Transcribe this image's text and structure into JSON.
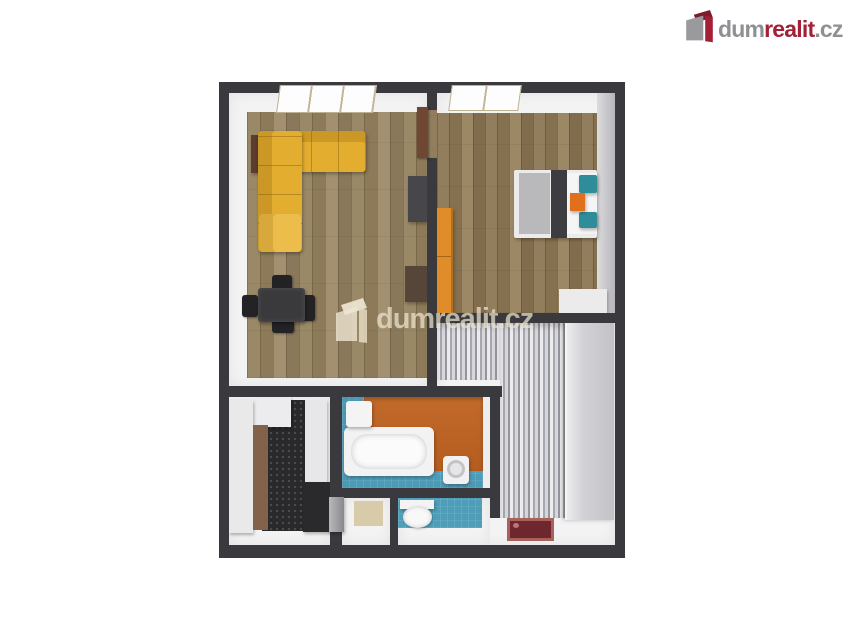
{
  "brand": {
    "dum": "dum",
    "realit": "realit",
    "cz": ".cz",
    "colors": {
      "gray": "#8f9093",
      "red": "#a32037",
      "lid_dark_red": "#7c1d2e"
    }
  },
  "watermark": {
    "text": "dumrealit.cz"
  },
  "floorplan": {
    "type": "3d-top-down-floor-plan",
    "rooms": [
      {
        "name": "living-room",
        "floor": "wood-plank",
        "furniture": [
          "yellow-corner-sofa",
          "side-table",
          "dining-table",
          "four-chairs",
          "tv-cabinet",
          "sideboard",
          "open-door"
        ]
      },
      {
        "name": "bedroom",
        "floor": "wood-plank",
        "furniture": [
          "double-bed",
          "teal-pillows",
          "orange-bedside-table",
          "orange-wardrobe",
          "white-dresser"
        ]
      },
      {
        "name": "hallway",
        "floor": "gray-striped-runner",
        "furniture": [
          "tall-wardrobe",
          "dark-red-doormat"
        ]
      },
      {
        "name": "bathroom",
        "floor": "blue-tile",
        "walls": "orange-accent",
        "furniture": [
          "bathtub",
          "washbasin",
          "washing-machine"
        ]
      },
      {
        "name": "wc",
        "floor": "blue-tile",
        "furniture": [
          "toilet"
        ]
      },
      {
        "name": "closet",
        "floor": "beige",
        "furniture": []
      },
      {
        "name": "entry",
        "floor": "dark-speckled-tile",
        "furniture": [
          "white-wardrobe",
          "upper-cabinet",
          "counter-cabinet",
          "fridge",
          "waste-bin"
        ]
      }
    ],
    "palette": {
      "wall": "#3a3a3e",
      "wood": "#968465",
      "sofa_yellow": "#e3ad30",
      "wardrobe_orange": "#df8d2b",
      "teal": "#2f8d9a",
      "bath_blue": "#4e9eb9",
      "bath_orange": "#bd6223",
      "doormat_red": "#6f262f"
    }
  }
}
